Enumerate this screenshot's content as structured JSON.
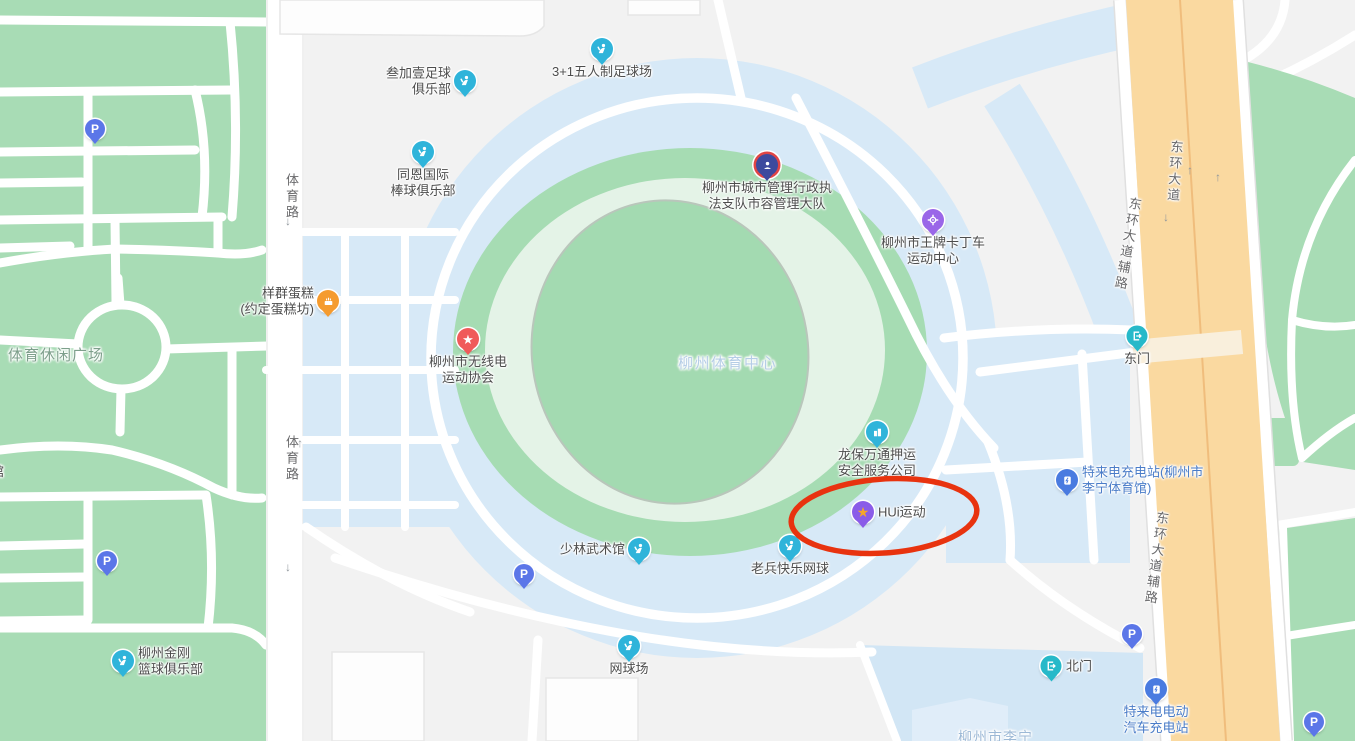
{
  "colors": {
    "background": "#f2f2f2",
    "park_green": "#a8dcb5",
    "stadium_outer_green": "#a6dcb3",
    "stadium_mint": "#e4f3e7",
    "stadium_inner_green": "#a3dab1",
    "water_blue": "#d7e9f7",
    "road_white": "#ffffff",
    "avenue_yellow": "#fad9a0",
    "avenue_center_line": "#f0bd7c",
    "poi_text": "#4d4d4d",
    "ev_text": "#4a7cc8",
    "annotation_red": "#e8330f",
    "sports_icon": "#2fb4da",
    "parking_icon": "#5b76e8",
    "gate_icon": "#27b9c9",
    "government_icon": "#3d4a9e",
    "kart_icon": "#9a66e8",
    "cake_icon": "#f59b2e",
    "star_icon": "#f05a5a",
    "hui_icon": "#8a5ce8"
  },
  "area_labels": [
    {
      "name": "sports-leisure-plaza-label",
      "text": "体育休闲广场",
      "x": 8,
      "y": 344,
      "size": 15,
      "color": "#7d9f8b",
      "spacing": 1
    },
    {
      "name": "stadium-center-label",
      "text": "柳州体育中心",
      "x": 678,
      "y": 352,
      "size": 15,
      "color": "#b5cde6",
      "spacing": 1.5
    },
    {
      "name": "lining-stadium-label",
      "text": "柳州市李宁",
      "x": 958,
      "y": 727,
      "size": 14,
      "color": "#9db9d6",
      "spacing": 1
    },
    {
      "name": "edge-partial-label",
      "text": "馆",
      "x": -9,
      "y": 461,
      "size": 13,
      "color": "#4d4d4d",
      "spacing": 0
    }
  ],
  "road_labels": [
    {
      "name": "tiyu-road-label-upper",
      "text": "体育路",
      "x": 282,
      "y": 173,
      "rotate": 0
    },
    {
      "name": "tiyu-road-label-lower",
      "text": "体育路",
      "x": 282,
      "y": 435,
      "rotate": 0
    },
    {
      "name": "donghuan-avenue-label",
      "text": "东环大道",
      "x": 1167,
      "y": 140,
      "rotate": 4
    },
    {
      "name": "donghuan-frontage-label-upper",
      "text": "东环大道辅路",
      "x": 1126,
      "y": 197,
      "rotate": 10
    },
    {
      "name": "donghuan-frontage-label-lower",
      "text": "东环大道辅路",
      "x": 1153,
      "y": 511,
      "rotate": 8
    }
  ],
  "arrows": [
    {
      "x": 294,
      "y": 177,
      "dir": "up"
    },
    {
      "x": 288,
      "y": 221,
      "dir": "down"
    },
    {
      "x": 300,
      "y": 443,
      "dir": "up"
    },
    {
      "x": 288,
      "y": 567,
      "dir": "down"
    },
    {
      "x": 1190,
      "y": 170,
      "dir": "up"
    },
    {
      "x": 1218,
      "y": 177,
      "dir": "up"
    },
    {
      "x": 1166,
      "y": 217,
      "dir": "down"
    }
  ],
  "pois": [
    {
      "name": "sanjiayi-football-club",
      "icon": "sports",
      "x": 465,
      "y": 81,
      "lines": [
        "叁加壹足球",
        "俱乐部"
      ],
      "place": "left"
    },
    {
      "name": "futsal-field-3plus1",
      "icon": "sports",
      "x": 602,
      "y": 49,
      "lines": [
        "3+1五人制足球场"
      ],
      "place": "below"
    },
    {
      "name": "tongen-baseball-club",
      "icon": "sports",
      "x": 423,
      "y": 152,
      "lines": [
        "同恩国际",
        "棒球俱乐部"
      ],
      "place": "below"
    },
    {
      "name": "yangqun-cake-shop",
      "icon": "cake",
      "x": 328,
      "y": 301,
      "lines": [
        "样群蛋糕",
        "(约定蛋糕坊)"
      ],
      "place": "left"
    },
    {
      "name": "radio-sports-association",
      "icon": "star",
      "x": 468,
      "y": 339,
      "lines": [
        "柳州市无线电",
        "运动协会"
      ],
      "place": "below"
    },
    {
      "name": "city-mgmt-law-enforcement",
      "icon": "gov",
      "x": 767,
      "y": 165,
      "lines": [
        "柳州市城市管理行政执",
        "法支队市容管理大队"
      ],
      "place": "below"
    },
    {
      "name": "wangpai-kart-center",
      "icon": "kart",
      "x": 933,
      "y": 220,
      "lines": [
        "柳州市王牌卡丁车",
        "运动中心"
      ],
      "place": "below"
    },
    {
      "name": "longbao-escort-security",
      "icon": "building",
      "x": 877,
      "y": 432,
      "lines": [
        "龙保万通押运",
        "安全服务公司"
      ],
      "place": "below"
    },
    {
      "name": "hui-sports",
      "icon": "hui",
      "x": 863,
      "y": 512,
      "lines": [
        "HUi运动"
      ],
      "place": "right"
    },
    {
      "name": "teld-charging-lining",
      "icon": "ev",
      "x": 1067,
      "y": 480,
      "lines": [
        "特来电充电站(柳州市",
        "李宁体育馆)"
      ],
      "place": "right",
      "label_color": "#4a7cc8"
    },
    {
      "name": "east-gate",
      "icon": "gate",
      "x": 1137,
      "y": 336,
      "lines": [
        "东门"
      ],
      "place": "below"
    },
    {
      "name": "shaolin-martial-arts",
      "icon": "sports",
      "x": 639,
      "y": 549,
      "lines": [
        "少林武术馆"
      ],
      "place": "left"
    },
    {
      "name": "laobing-happy-tennis",
      "icon": "sports",
      "x": 790,
      "y": 546,
      "lines": [
        "老兵快乐网球"
      ],
      "place": "below"
    },
    {
      "name": "tennis-court",
      "icon": "sports",
      "x": 629,
      "y": 646,
      "lines": [
        "网球场"
      ],
      "place": "below"
    },
    {
      "name": "jingang-basketball-club",
      "icon": "sports",
      "x": 123,
      "y": 661,
      "lines": [
        "柳州金刚",
        "篮球俱乐部"
      ],
      "place": "right"
    },
    {
      "name": "north-gate",
      "icon": "gate",
      "x": 1051,
      "y": 666,
      "lines": [
        "北门"
      ],
      "place": "right"
    },
    {
      "name": "teld-ev-charging-station",
      "icon": "ev",
      "x": 1156,
      "y": 689,
      "lines": [
        "特来电电动",
        "汽车充电站"
      ],
      "place": "below",
      "label_color": "#4a7cc8"
    }
  ],
  "parking_markers": [
    {
      "x": 95,
      "y": 129
    },
    {
      "x": 107,
      "y": 561
    },
    {
      "x": 524,
      "y": 574
    },
    {
      "x": 1132,
      "y": 634
    },
    {
      "x": 1314,
      "y": 722
    }
  ],
  "annotation": {
    "shape": "ellipse",
    "cx": 884,
    "cy": 516,
    "rx": 93,
    "ry": 37,
    "rotate": -4,
    "stroke": "#e8330f",
    "stroke_width": 5.5
  }
}
